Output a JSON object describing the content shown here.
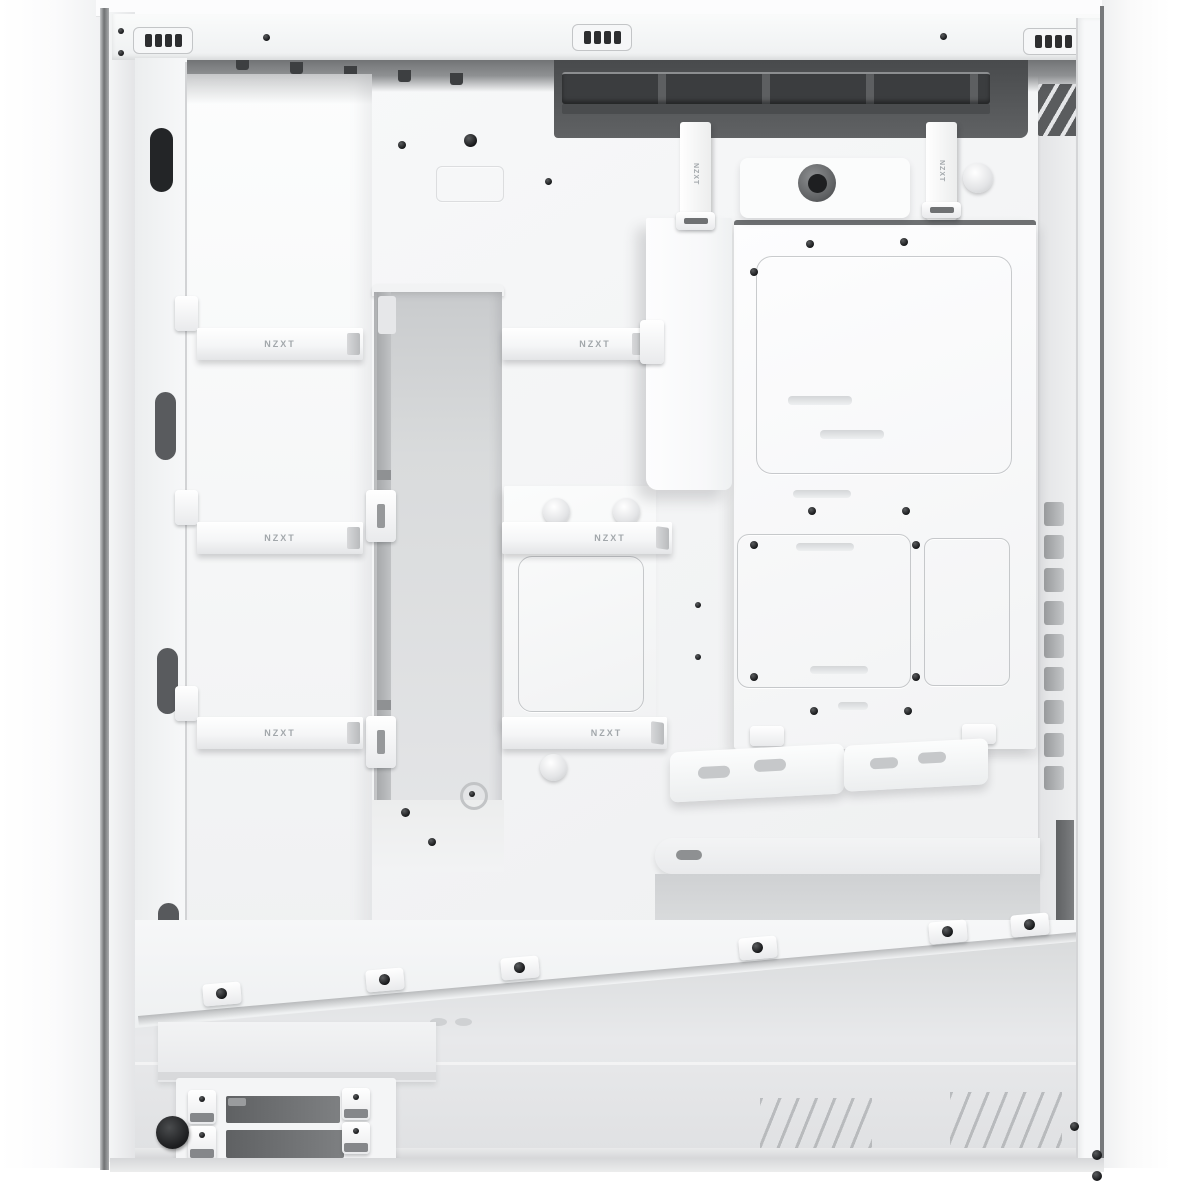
{
  "scene": {
    "type": "product-photo",
    "subject": "White mid-tower PC case interior, cable-management side, side panel removed",
    "background_color": "#ffffff"
  },
  "branding": {
    "strap_label": "NZXT"
  },
  "palette": {
    "case_white": "#f7f8f9",
    "panel_gray": "#e8e9eb",
    "recess_gray": "#d7d9da",
    "dark_interior": "#47494b",
    "cutout_dark": "#232527",
    "screw_black": "#151617"
  },
  "inventory": {
    "top_vent_grilles": 3,
    "horizontal_cable_straps": 6,
    "vertical_cable_straps": 2,
    "front_frame_cutouts": 4,
    "drive_tray_slots": 2,
    "right_tie_down_slots": 9
  }
}
